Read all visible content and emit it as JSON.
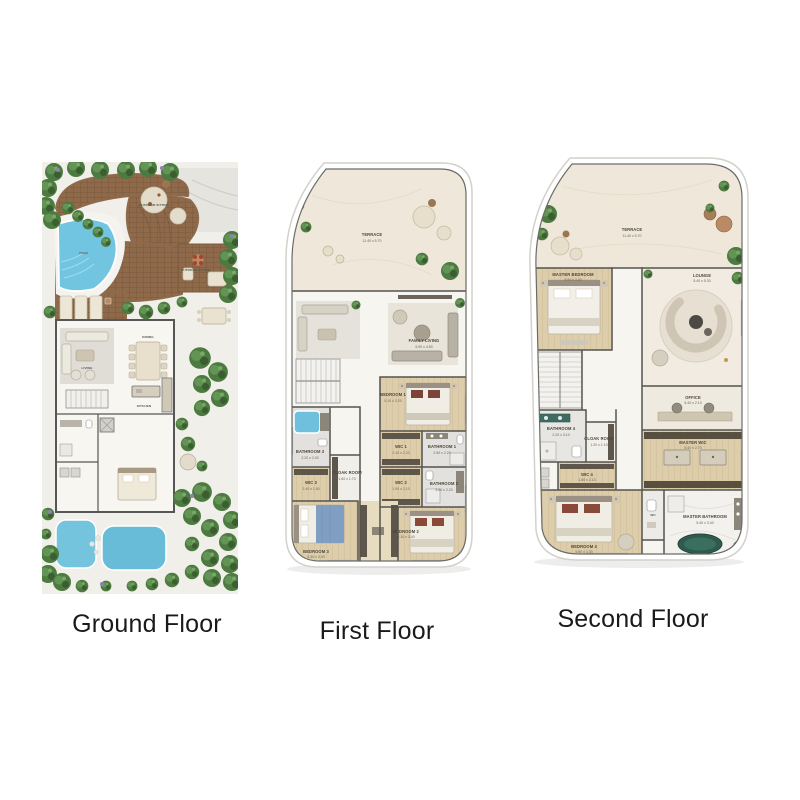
{
  "captions": {
    "ground": "Ground Floor",
    "first": "First Floor",
    "second": "Second Floor"
  },
  "colors": {
    "pool_blue": "#72c5e1",
    "greenery": "#54803f",
    "deck_wood": "#8e6a4b",
    "interior_wood": "#decdab",
    "terrace_cream": "#efe8da",
    "tub_green": "#2e5b4e",
    "wall_gray": "#55534e",
    "caption_text": "#1a1a1a"
  },
  "ground": {
    "labels": {
      "pool": "POOL",
      "outdoor_sitting_top": "OUTDOOR SITTING",
      "outdoor_sitting_right": "OUTDOOR SITTING",
      "living": "LIVING",
      "dining": "DINING",
      "kitchen": "KITCHEN"
    }
  },
  "first": {
    "rooms": [
      {
        "name": "TERRACE",
        "dims": "11.40 x 5.70"
      },
      {
        "name": "FAMILY LIVING",
        "dims": "5.90 x 4.50"
      },
      {
        "name": "BEDROOM 1",
        "dims": "5.10 x 3.20"
      },
      {
        "name": "WIC 1",
        "dims": "2.10 x 2.20"
      },
      {
        "name": "BATHROOM 1",
        "dims": "2.90 x 2.20"
      },
      {
        "name": "BATHROOM 3",
        "dims": "2.20 x 2.00"
      },
      {
        "name": "CLOAK ROOM",
        "dims": "1.60 x 1.70"
      },
      {
        "name": "WIC 3",
        "dims": "2.40 x 1.80"
      },
      {
        "name": "WIC 2",
        "dims": "1.90 x 2.10"
      },
      {
        "name": "BATHROOM 2",
        "dims": "3.50 x 2.20"
      },
      {
        "name": "BEDROOM 3",
        "dims": "5.30 x 3.40"
      },
      {
        "name": "BEDROOM 2",
        "dims": "5.10 x 3.40"
      }
    ]
  },
  "second": {
    "rooms": [
      {
        "name": "TERRACE",
        "dims": "11.40 x 5.70"
      },
      {
        "name": "MASTER BEDROOM",
        "dims": "5.90 x 3.40"
      },
      {
        "name": "LOUNGE",
        "dims": "5.40 x 5.30"
      },
      {
        "name": "OFFICE",
        "dims": "5.40 x 2.10"
      },
      {
        "name": "BATHROOM 4",
        "dims": "2.20 x 3.10"
      },
      {
        "name": "CLOAK ROOM",
        "dims": "1.20 x 1.10"
      },
      {
        "name": "WIC 4",
        "dims": "1.80 x 2.10"
      },
      {
        "name": "MASTER WIC",
        "dims": "5.40 x 2.70"
      },
      {
        "name": "MASTER BATHROOM",
        "dims": "5.40 x 3.40"
      },
      {
        "name": "WC",
        "dims": ""
      },
      {
        "name": "BEDROOM 4",
        "dims": "5.90 x 3.30"
      }
    ]
  }
}
